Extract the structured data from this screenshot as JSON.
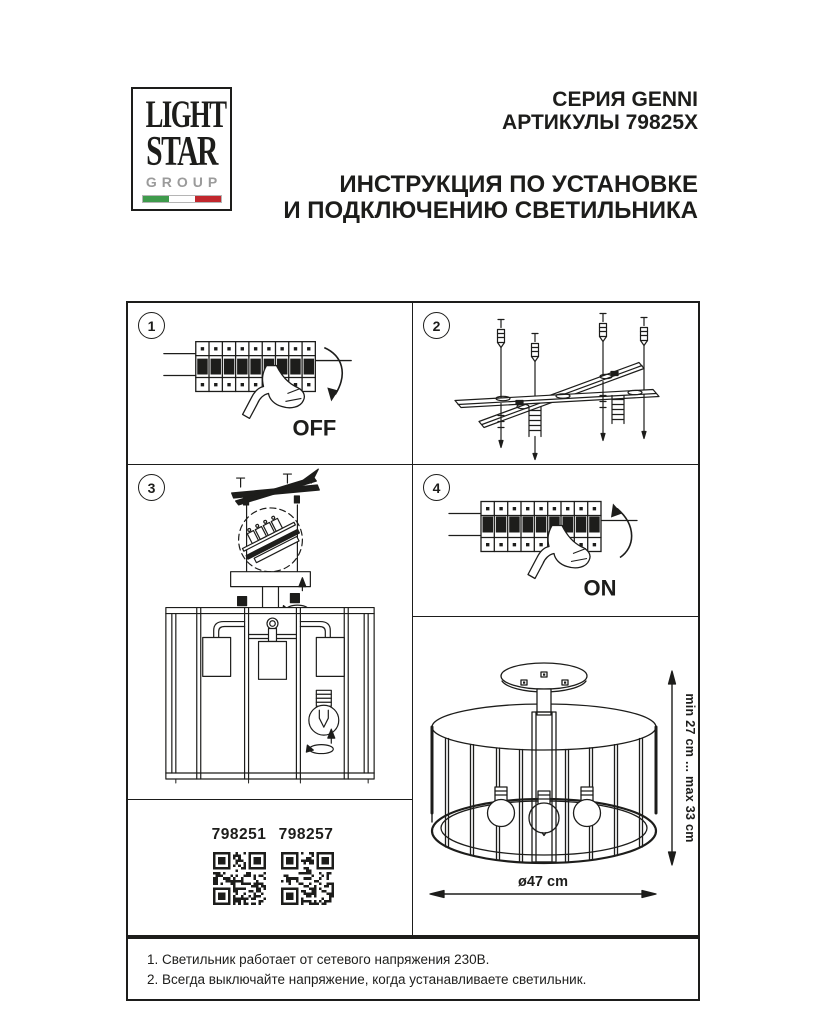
{
  "header": {
    "logo": {
      "word1": "LIGHT",
      "word2": "STAR",
      "word3": "GROUP"
    },
    "series": "СЕРИЯ GENNI",
    "articles": "АРТИКУЛЫ 79825X",
    "title_line1": "ИНСТРУКЦИЯ ПО УСТАНОВКЕ",
    "title_line2": "И ПОДКЛЮЧЕНИЮ СВЕТИЛЬНИКА"
  },
  "steps": {
    "one": {
      "num": "1",
      "switch_label": "OFF"
    },
    "two": {
      "num": "2"
    },
    "three": {
      "num": "3"
    },
    "four": {
      "num": "4",
      "switch_label": "ON"
    }
  },
  "products": {
    "codes": [
      "798251",
      "798257"
    ]
  },
  "dimensions": {
    "height_range": "min 27 cm ... max 33 cm",
    "diameter": "ø47 cm"
  },
  "notes": [
    "1. Светильник работает от сетевого напряжения 230В.",
    "2. Всегда выключайте напряжение, когда устанавливаете светильник."
  ],
  "colors": {
    "ink": "#1d1d1b",
    "flag_green": "#3f9b4c",
    "flag_red": "#c1272d",
    "logo_gray": "#9b9b9b"
  }
}
